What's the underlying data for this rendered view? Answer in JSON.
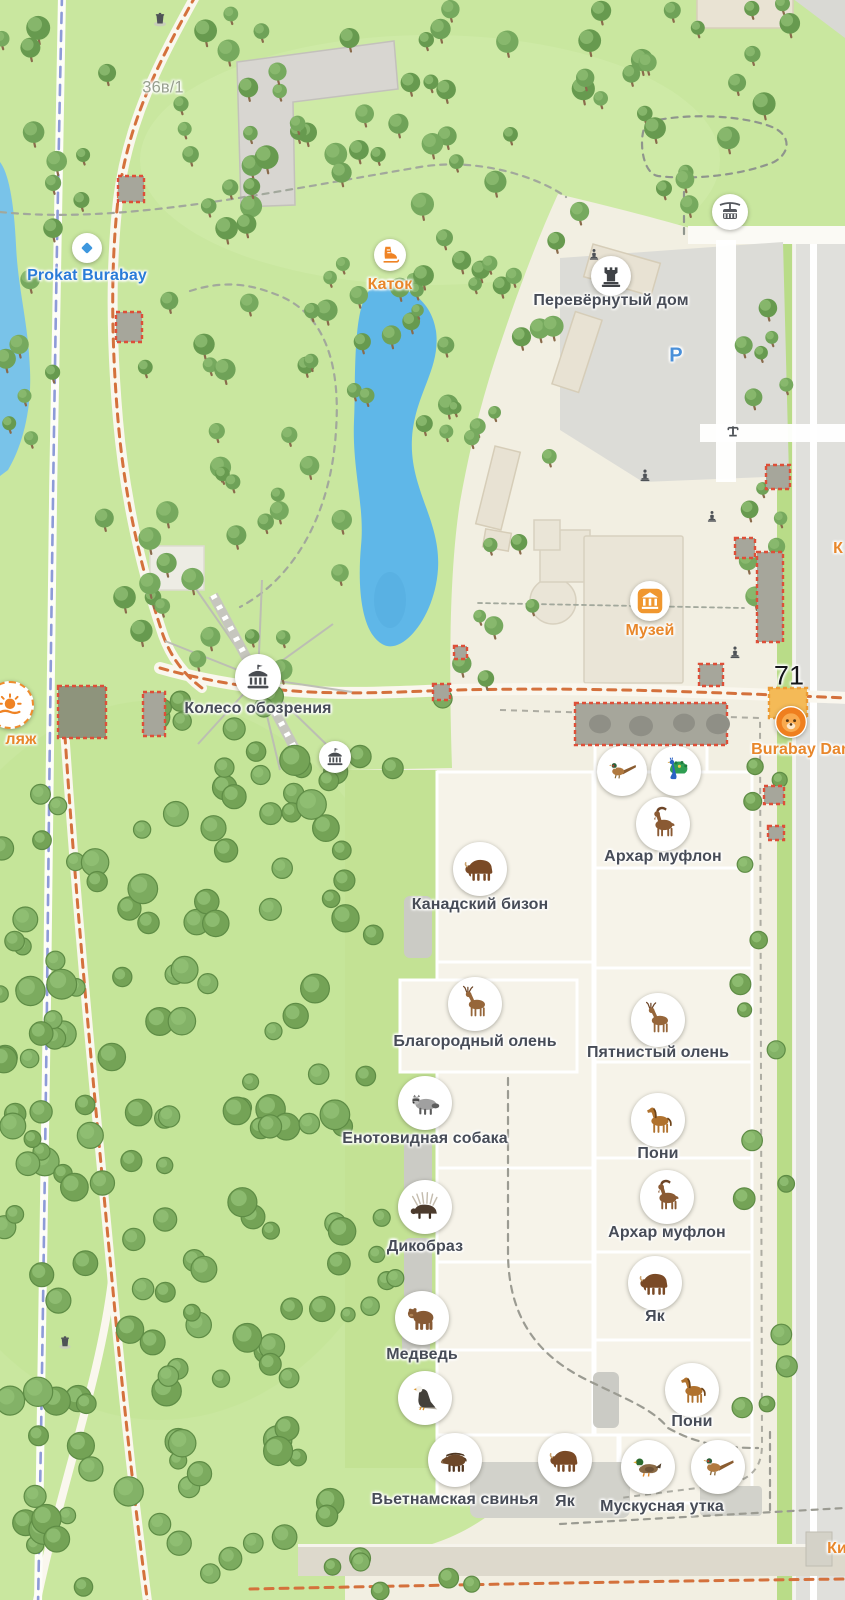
{
  "colors": {
    "park_green": "#c9e79f",
    "plaza_beige": "#f2efe2",
    "lake_blue": "#5fb7e8",
    "label_dark": "#474c57",
    "label_orange": "#e8872b",
    "label_blue": "#2b7cd8",
    "route_orange": "#d4713c",
    "bike_blue": "#8d9bd8",
    "construction_red": "#dd4f38",
    "construction_fill": "#a6a69b",
    "construction_dark": "#8e947c",
    "construction_orange_fill": "#f4ba57",
    "construction_orange_stroke": "#ec9b35",
    "tree_trunk": "#8a6b4c",
    "tree_bodies": [
      "#6fa258",
      "#679a4f",
      "#76a95e"
    ],
    "tree_light": "#8cbb70",
    "bush_bodies": [
      "#7cab5f",
      "#74a356",
      "#83b267"
    ],
    "bush_light": "#92c175",
    "bush_rim": "#5e8c45"
  },
  "pois": [
    {
      "id": "address-36v1",
      "label": "36в/1",
      "x": 163,
      "y": 88,
      "lcls": "lab-gray"
    },
    {
      "id": "prokat-burabay",
      "label": "Prokat Burabay",
      "icon": "diamond",
      "r": 15,
      "gs": 18,
      "x": 87,
      "y": 248,
      "lcls": "lab-blue",
      "ldy": 28
    },
    {
      "id": "katok",
      "label": "Каток",
      "icon": "skate",
      "r": 16,
      "gs": 22,
      "x": 390,
      "y": 255,
      "lcls": "lab-orange",
      "ldy": 30
    },
    {
      "id": "perevernuty-dom",
      "label": "Перевёрнутый дом",
      "icon": "tower",
      "r": 20,
      "gs": 26,
      "x": 611,
      "y": 276,
      "ldy": 25
    },
    {
      "id": "parking",
      "label": "P",
      "x": 676,
      "y": 356,
      "lcls": "lab-parking"
    },
    {
      "id": "cable-car",
      "icon": "cablecar",
      "r": 18,
      "gs": 24,
      "x": 730,
      "y": 212
    },
    {
      "id": "muzei",
      "label": "Музей",
      "icon": "museum",
      "r": 20,
      "gs": 28,
      "x": 650,
      "y": 601,
      "lcls": "lab-orange",
      "ldy": 30
    },
    {
      "id": "koleso-obozreniya",
      "label": "Колесо обозрения",
      "icon": "carousel",
      "r": 23,
      "gs": 28,
      "x": 258,
      "y": 677,
      "ldy": 32
    },
    {
      "id": "attraction",
      "icon": "carousel",
      "r": 16,
      "gs": 20,
      "x": 335,
      "y": 757
    },
    {
      "id": "stop-71",
      "label": "71",
      "x": 789,
      "y": 676,
      "lcls": "lab-black"
    },
    {
      "id": "burabay-dan",
      "label": "Burabay Dan",
      "icon": "lion",
      "r": 16,
      "gs": 32,
      "x": 791,
      "y": 722,
      "lcls": "lab-orange",
      "ldx": 10,
      "ldy": 28
    },
    {
      "id": "plyazh",
      "label": "ляж",
      "icon": "sun",
      "r": 22,
      "gs": 30,
      "x": 10,
      "y": 705,
      "lcls": "lab-orange",
      "ring": true,
      "ldx": 11,
      "ldy": 35
    },
    {
      "id": "poi-k-right",
      "label": "К",
      "x": 838,
      "y": 549,
      "lcls": "lab-orange"
    },
    {
      "id": "kiosk",
      "label": "Ки",
      "x": 837,
      "y": 1549,
      "lcls": "lab-orange"
    }
  ],
  "animals": [
    {
      "id": "pheasant-top",
      "icon": "pheasant",
      "x": 622,
      "y": 771,
      "r": 25
    },
    {
      "id": "peacock",
      "icon": "peacock",
      "x": 676,
      "y": 771,
      "r": 25
    },
    {
      "id": "arkhar-muflon-1",
      "label": "Архар муфлон",
      "icon": "ibex",
      "x": 663,
      "y": 824,
      "ldy": 33
    },
    {
      "id": "kanadsky-bizon",
      "label": "Канадский бизон",
      "icon": "bison",
      "x": 480,
      "y": 869,
      "ldy": 36
    },
    {
      "id": "blagorodny-olen",
      "label": "Благородный олень",
      "icon": "deer",
      "x": 475,
      "y": 1004,
      "ldy": 38
    },
    {
      "id": "pyatnisty-olen",
      "label": "Пятнистый олень",
      "icon": "deer",
      "x": 658,
      "y": 1020,
      "ldy": 33
    },
    {
      "id": "enotovidnaya-sobaka",
      "label": "Енотовидная собака",
      "icon": "raccoon",
      "x": 425,
      "y": 1103,
      "ldy": 36
    },
    {
      "id": "poni-1",
      "label": "Пони",
      "icon": "horse",
      "x": 658,
      "y": 1120,
      "ldy": 34
    },
    {
      "id": "dikobraz",
      "label": "Дикобраз",
      "icon": "porcupine",
      "x": 425,
      "y": 1207,
      "ldy": 40
    },
    {
      "id": "arkhar-muflon-2",
      "label": "Архар муфлон",
      "icon": "ibex",
      "x": 667,
      "y": 1197,
      "ldy": 36
    },
    {
      "id": "yak-1",
      "label": "Як",
      "icon": "bison",
      "x": 655,
      "y": 1283,
      "ldy": 34
    },
    {
      "id": "medved",
      "label": "Медведь",
      "icon": "bear",
      "x": 422,
      "y": 1318,
      "ldy": 37
    },
    {
      "id": "eagle",
      "icon": "eagle",
      "x": 425,
      "y": 1398
    },
    {
      "id": "poni-2",
      "label": "Пони",
      "icon": "horse",
      "x": 692,
      "y": 1390,
      "ldy": 32
    },
    {
      "id": "vietnamskaya-svinya",
      "label": "Вьетнамская свинья",
      "icon": "boar",
      "x": 455,
      "y": 1460,
      "ldy": 40
    },
    {
      "id": "yak-2",
      "label": "Як",
      "icon": "bison",
      "x": 565,
      "y": 1460,
      "ldy": 42
    },
    {
      "id": "muskusnaya-utka",
      "label": "Мускусная утка",
      "icon": "duck",
      "x": 648,
      "y": 1467,
      "ldx": 14,
      "ldy": 40
    },
    {
      "id": "pheasant-bottom",
      "icon": "pheasant",
      "x": 718,
      "y": 1467
    }
  ],
  "glyphs": [
    {
      "icon": "trash",
      "x": 160,
      "y": 22,
      "s": 16
    },
    {
      "icon": "trash",
      "x": 65,
      "y": 1345,
      "s": 15
    },
    {
      "icon": "statue",
      "x": 594,
      "y": 257,
      "s": 13
    },
    {
      "icon": "statue",
      "x": 645,
      "y": 478,
      "s": 14
    },
    {
      "icon": "statue",
      "x": 712,
      "y": 519,
      "s": 13
    },
    {
      "icon": "statue",
      "x": 735,
      "y": 655,
      "s": 14
    },
    {
      "icon": "barrier",
      "x": 733,
      "y": 434,
      "s": 15
    }
  ],
  "construction": {
    "squares": [
      [
        118,
        176,
        26,
        26,
        "n"
      ],
      [
        116,
        312,
        26,
        30,
        "n"
      ],
      [
        58,
        686,
        48,
        52,
        "d"
      ],
      [
        143,
        692,
        22,
        44,
        "n"
      ],
      [
        433,
        684,
        17,
        16,
        "n"
      ],
      [
        454,
        646,
        13,
        13,
        "n"
      ],
      [
        766,
        465,
        24,
        24,
        "n"
      ],
      [
        735,
        538,
        20,
        20,
        "n"
      ],
      [
        757,
        552,
        26,
        90,
        "n"
      ],
      [
        699,
        664,
        24,
        22,
        "n"
      ],
      [
        764,
        786,
        20,
        18,
        "n"
      ],
      [
        768,
        826,
        16,
        14,
        "n"
      ],
      [
        769,
        688,
        38,
        30,
        "o"
      ]
    ],
    "blob": {
      "x": 575,
      "y": 703,
      "w": 152,
      "h": 42,
      "dots": [
        [
          600,
          724,
          11
        ],
        [
          641,
          726,
          12
        ],
        [
          684,
          723,
          11
        ],
        [
          718,
          724,
          12
        ]
      ]
    }
  },
  "tree_clusters": [
    {
      "style": "tree",
      "x": 0,
      "y": 8,
      "w": 600,
      "h": 235,
      "n": 58,
      "seed": 11,
      "rmin": 7,
      "rmax": 12
    },
    {
      "style": "tree",
      "x": 600,
      "y": 0,
      "w": 245,
      "h": 228,
      "n": 20,
      "seed": 22,
      "rmin": 7,
      "rmax": 12
    },
    {
      "style": "tree",
      "x": 95,
      "y": 245,
      "w": 130,
      "h": 430,
      "n": 16,
      "seed": 33,
      "rmin": 7,
      "rmax": 12
    },
    {
      "style": "tree",
      "x": 200,
      "y": 250,
      "w": 255,
      "h": 185,
      "n": 24,
      "seed": 44,
      "rmin": 6,
      "rmax": 11
    },
    {
      "style": "tree",
      "x": 438,
      "y": 250,
      "w": 125,
      "h": 430,
      "n": 22,
      "seed": 55,
      "rmin": 6,
      "rmax": 11
    },
    {
      "style": "tree",
      "x": 195,
      "y": 430,
      "w": 150,
      "h": 240,
      "n": 14,
      "seed": 66,
      "rmin": 7,
      "rmax": 12
    },
    {
      "style": "bush",
      "x": 140,
      "y": 690,
      "w": 310,
      "h": 150,
      "n": 20,
      "seed": 77,
      "rmin": 8,
      "rmax": 13
    },
    {
      "style": "bush",
      "x": 0,
      "y": 760,
      "w": 348,
      "h": 800,
      "n": 145,
      "seed": 88,
      "rmin": 8,
      "rmax": 15
    },
    {
      "style": "bush",
      "x": 348,
      "y": 775,
      "w": 85,
      "h": 660,
      "n": 9,
      "seed": 99,
      "rmin": 7,
      "rmax": 11
    },
    {
      "style": "tree",
      "x": 742,
      "y": 238,
      "w": 48,
      "h": 420,
      "n": 13,
      "seed": 110,
      "rmin": 6,
      "rmax": 10
    },
    {
      "style": "bush",
      "x": 740,
      "y": 765,
      "w": 55,
      "h": 670,
      "n": 15,
      "seed": 121,
      "rmin": 7,
      "rmax": 11
    },
    {
      "style": "bush",
      "x": 60,
      "y": 1556,
      "w": 430,
      "h": 38,
      "n": 8,
      "seed": 132,
      "rmin": 7,
      "rmax": 11
    },
    {
      "style": "tree",
      "x": 0,
      "y": 245,
      "w": 60,
      "h": 270,
      "n": 7,
      "seed": 143,
      "rmin": 6,
      "rmax": 10
    }
  ]
}
